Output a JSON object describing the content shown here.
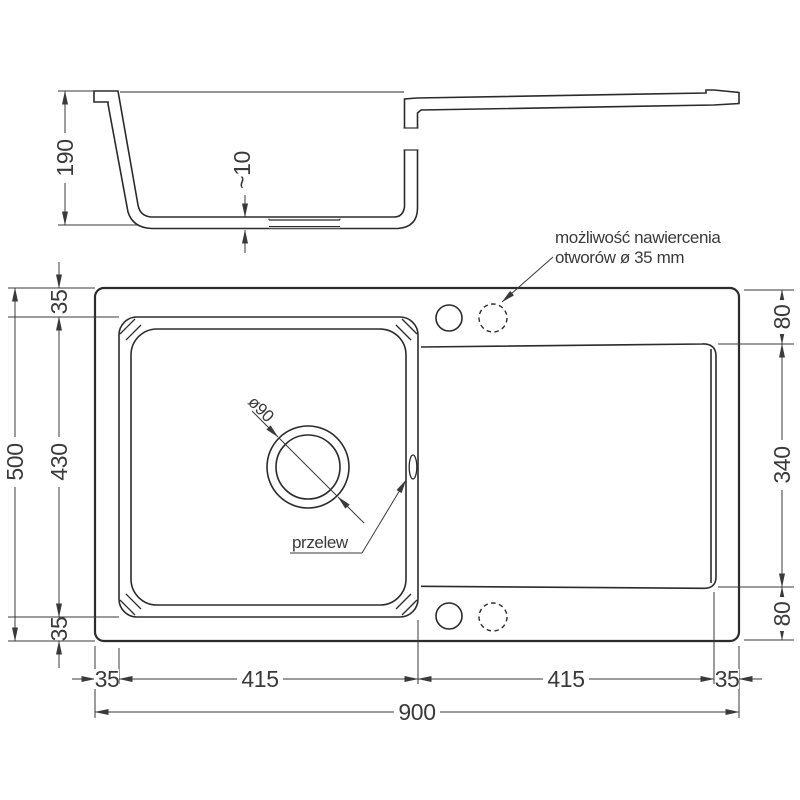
{
  "section": {
    "height": "190",
    "bottom_thickness": "~10"
  },
  "plan": {
    "left": {
      "total": "500",
      "bowl": "430",
      "top_margin": "35",
      "bottom_margin": "35"
    },
    "right": {
      "top_deck": "80",
      "drainer": "340",
      "bottom_deck": "80"
    },
    "bottom": {
      "left_margin": "35",
      "bowl_width": "415",
      "drainer_width": "415",
      "right_margin": "35",
      "total": "900"
    }
  },
  "labels": {
    "drill_note_line1": "możliwość nawiercenia",
    "drill_note_line2": "otworów ø 35 mm",
    "overflow": "przelew",
    "drain_diameter": "ø90"
  },
  "colors": {
    "line": "#2b2b2b",
    "dim": "#3a3a3a",
    "background": "#ffffff"
  }
}
